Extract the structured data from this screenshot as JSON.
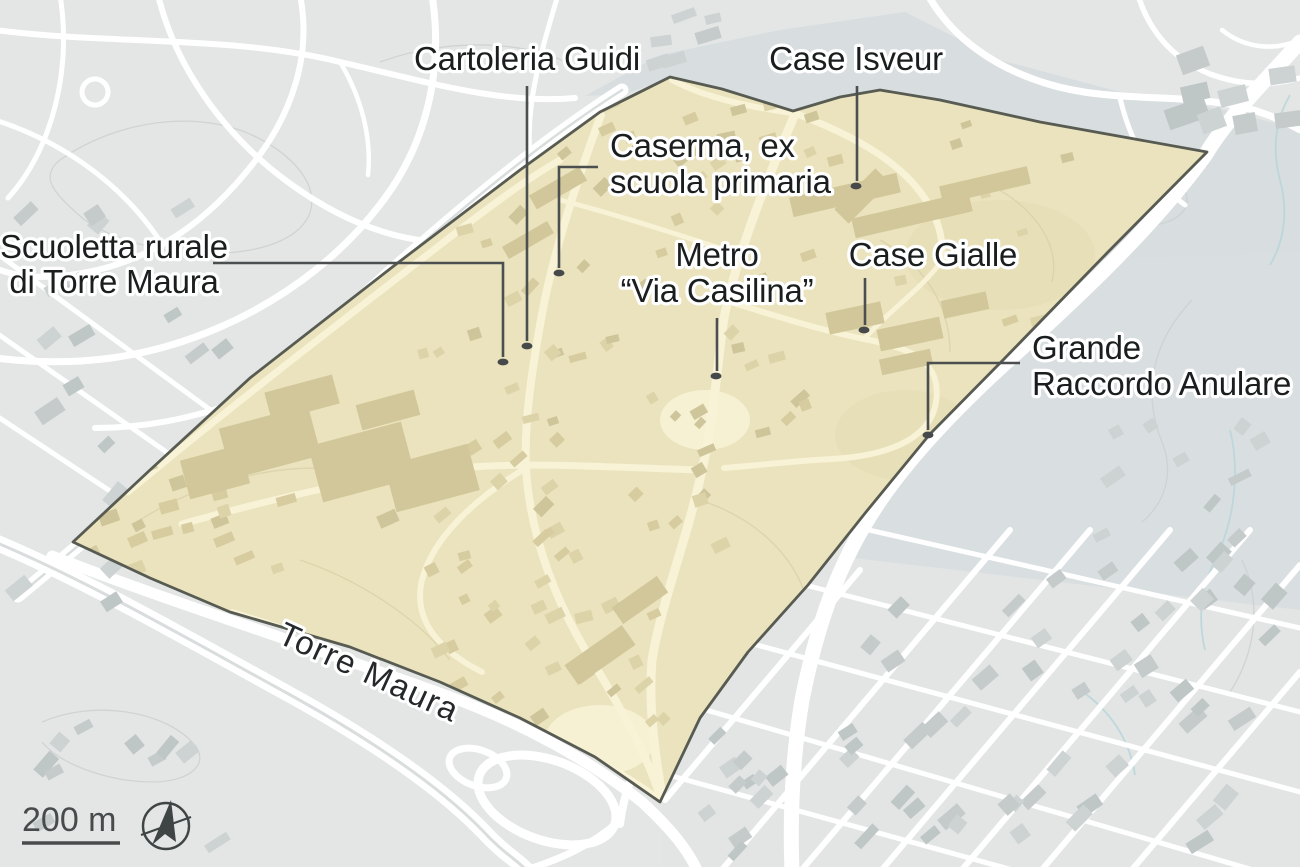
{
  "map": {
    "description": "Isometric locator map of the Torre Maura district (Rome) with a beige highlighted area and labelled points of interest",
    "highlight_area_name": "Torre Maura",
    "road_label": {
      "text": "Torre Maura",
      "rotation_deg": 24.5
    },
    "scale_bar": {
      "label": "200 m"
    },
    "compass": {
      "icon": "north-arrow-icon"
    },
    "colors": {
      "base_gray": "#e3e6e5",
      "tint_blue_gray": "#d8dde0",
      "highlight_fill": "#eae3bd",
      "highlight_outline": "#575b51",
      "inside_road": "#f8f2d6",
      "building_gray": "#c5cbcb",
      "building_tan": "#d7cca0",
      "label_text": "#1b1e1e",
      "leader_line": "#4b4f4f",
      "water_blue": "#b9d6da"
    },
    "annotations": [
      {
        "id": "scuoletta-rurale",
        "lines": [
          "Scuoletta rurale",
          "di Torre Maura"
        ],
        "x": 114,
        "y": 258,
        "anchor": "middle",
        "line_height": 35,
        "leader": [
          [
            213,
            263
          ],
          [
            503,
            263
          ],
          [
            503,
            357
          ]
        ],
        "dot": [
          503,
          362
        ]
      },
      {
        "id": "cartoleria-guidi",
        "lines": [
          "Cartoleria Guidi"
        ],
        "x": 527,
        "y": 70,
        "anchor": "middle",
        "line_height": 36,
        "leader": [
          [
            527,
            86
          ],
          [
            527,
            341
          ]
        ],
        "dot": [
          527,
          346
        ]
      },
      {
        "id": "caserma-ex-scuola-primaria",
        "lines": [
          "Caserma, ex",
          "scuola primaria"
        ],
        "x": 610,
        "y": 157,
        "anchor": "start",
        "line_height": 36,
        "leader": [
          [
            598,
            167
          ],
          [
            559,
            167
          ],
          [
            559,
            268
          ]
        ],
        "dot": [
          559,
          273
        ]
      },
      {
        "id": "case-isveur",
        "lines": [
          "Case Isveur"
        ],
        "x": 856,
        "y": 70,
        "anchor": "middle",
        "line_height": 36,
        "leader": [
          [
            857,
            86
          ],
          [
            857,
            181
          ]
        ],
        "dot": [
          856,
          186
        ]
      },
      {
        "id": "metro-via-casilina",
        "lines": [
          "Metro",
          "“Via Casilina”"
        ],
        "x": 717,
        "y": 266,
        "anchor": "middle",
        "line_height": 36,
        "leader": [
          [
            717,
            318
          ],
          [
            717,
            371
          ]
        ],
        "dot": [
          716,
          376
        ]
      },
      {
        "id": "case-gialle",
        "lines": [
          "Case Gialle"
        ],
        "x": 933,
        "y": 266,
        "anchor": "middle",
        "line_height": 36,
        "leader": [
          [
            865,
            278
          ],
          [
            865,
            325
          ]
        ],
        "dot": [
          864,
          330
        ]
      },
      {
        "id": "grande-raccordo-anulare",
        "lines": [
          "Grande",
          "Raccordo Anulare"
        ],
        "x": 1032,
        "y": 359,
        "anchor": "start",
        "line_height": 36,
        "leader": [
          [
            1020,
            363
          ],
          [
            928,
            363
          ],
          [
            928,
            430
          ]
        ],
        "dot": [
          928,
          435
        ]
      }
    ]
  }
}
